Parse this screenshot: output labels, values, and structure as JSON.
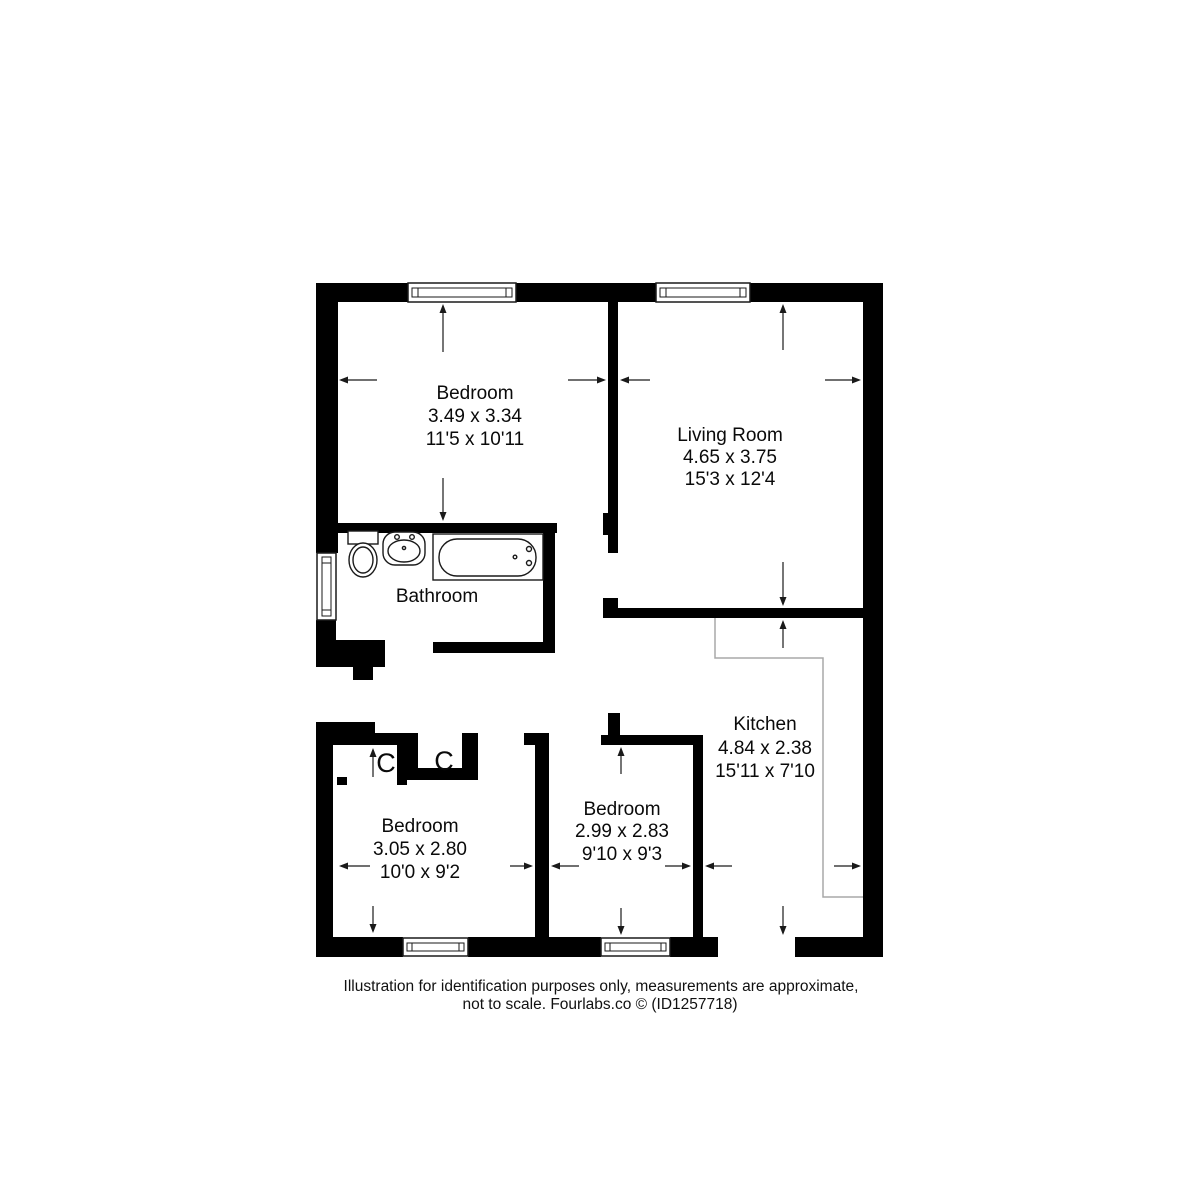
{
  "colors": {
    "wall": "#000000",
    "background": "#ffffff",
    "counter": "#a8a8a8",
    "text": "#0a0a0a"
  },
  "rooms": {
    "bedroom_top": {
      "name": "Bedroom",
      "metric": "3.49 x 3.34",
      "imperial": "11'5 x 10'11"
    },
    "living_room": {
      "name": "Living Room",
      "metric": "4.65 x 3.75",
      "imperial": "15'3 x 12'4"
    },
    "bathroom": {
      "name": "Bathroom"
    },
    "kitchen": {
      "name": "Kitchen",
      "metric": "4.84 x 2.38",
      "imperial": "15'11 x 7'10"
    },
    "bedroom_middle": {
      "name": "Bedroom",
      "metric": "2.99 x 2.83",
      "imperial": "9'10 x 9'3"
    },
    "bedroom_left": {
      "name": "Bedroom",
      "metric": "3.05 x 2.80",
      "imperial": "10'0 x 9'2"
    }
  },
  "closets": {
    "left_label": "C",
    "right_label": "C"
  },
  "footer": {
    "line1": "Illustration for identification purposes only, measurements are approximate,",
    "line2": "not to scale. Fourlabs.co © (ID1257718)"
  }
}
